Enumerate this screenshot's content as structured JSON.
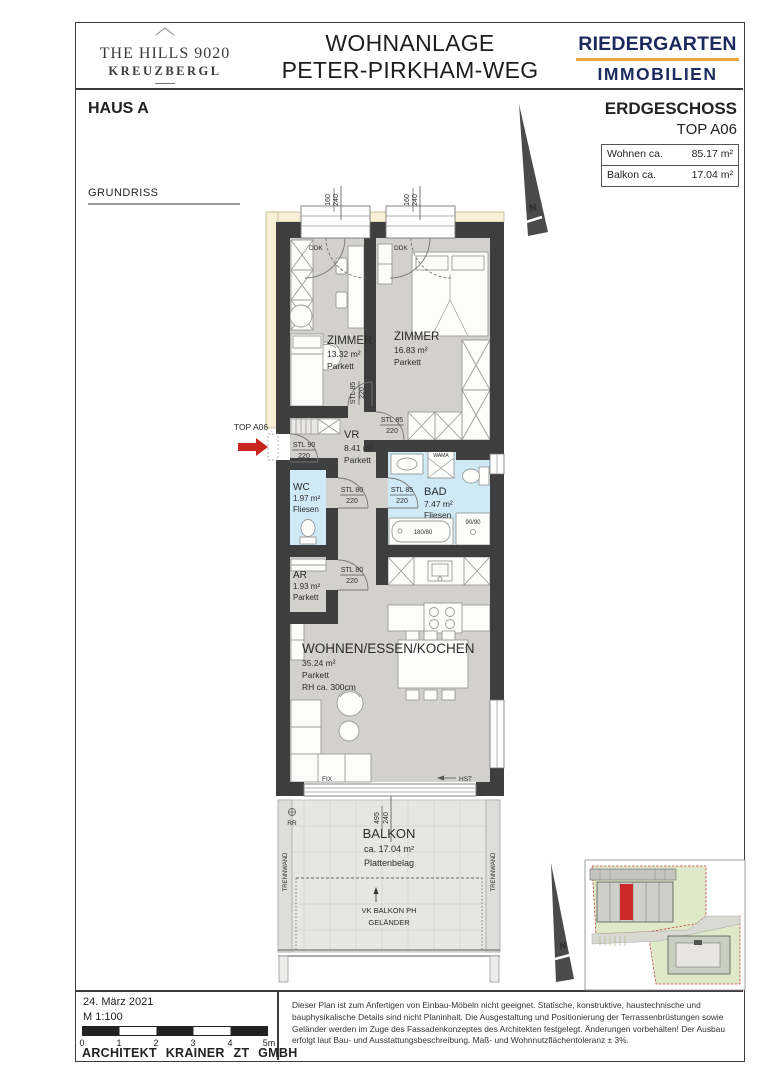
{
  "header": {
    "brand_left": {
      "line1": "THE HILLS 9020",
      "line2": "KREUZBERGL"
    },
    "project_title": {
      "line1": "WOHNANLAGE",
      "line2": "PETER-PIRKHAM-WEG"
    },
    "brand_right": {
      "line1": "RIEDERGARTEN",
      "line2": "IMMOBILIEN"
    }
  },
  "info": {
    "house": "HAUS A",
    "floor": "ERDGESCHOSS",
    "unit": "TOP A06",
    "area_table": {
      "rows": [
        {
          "label": "Wohnen ca.",
          "value": "85.17 m²"
        },
        {
          "label": "Balkon ca.",
          "value": "17.04 m²"
        }
      ]
    },
    "drawing_type": "GRUNDRISS"
  },
  "plan": {
    "north": "N",
    "entrance_label": "TOP A06",
    "rooms": {
      "zimmer1": {
        "name": "ZIMMER",
        "area": "13.32 m²",
        "floor": "Parkett"
      },
      "zimmer2": {
        "name": "ZIMMER",
        "area": "16.83 m²",
        "floor": "Parkett"
      },
      "vr": {
        "name": "VR",
        "area": "8.41 m²",
        "floor": "Parkett"
      },
      "wc": {
        "name": "WC",
        "area": "1.97 m²",
        "floor": "Fliesen"
      },
      "bad": {
        "name": "BAD",
        "area": "7.47 m²",
        "floor": "Fliesen"
      },
      "ar": {
        "name": "AR",
        "area": "1.93 m²",
        "floor": "Parkett"
      },
      "wohnen": {
        "name": "WOHNEN/ESSEN/KOCHEN",
        "area": "35.24 m²",
        "floor": "Parkett",
        "room_height": "RH ca. 300cm"
      },
      "balkon": {
        "name": "BALKON",
        "area": "ca. 17.04 m²",
        "floor": "Plattenbelag"
      }
    },
    "doors": {
      "entrance": {
        "type": "STL 90",
        "height": "220"
      },
      "zimmer1": {
        "type": "STL 85",
        "height": "220"
      },
      "zimmer2": {
        "type": "STL 85",
        "height": "220"
      },
      "wc": {
        "type": "STL 80",
        "height": "220"
      },
      "bad": {
        "type": "STL 85",
        "height": "220"
      },
      "ar": {
        "type": "STL 80",
        "height": "220"
      }
    },
    "dims": {
      "window": {
        "w": "160",
        "h": "240"
      },
      "balcony_door": {
        "w": "495",
        "h": "240"
      }
    },
    "annotations": {
      "ddk": "DDK",
      "fix": "FIX",
      "hst": "HST",
      "rr": "RR",
      "trennwand": "TRENNWAND",
      "vk_balkon": "VK BALKON PH",
      "gelaender": "GELÄNDER",
      "wama": "WAMA",
      "bathtub": "180/80",
      "shower": "90/90"
    }
  },
  "footer": {
    "date": "24. März 2021",
    "scale": "M 1:100",
    "scale_ticks": [
      "0",
      "1",
      "2",
      "3",
      "4",
      "5m"
    ],
    "architect": "ARCHITEKT KRAINER ZT GMBH",
    "disclaimer": "Dieser Plan ist zum Anfertigen von Einbau-Möbeln nicht geeignet. Statische, konstruktive, haustechnische und bauphysikalische Details sind nicht Planinhalt. Die Ausgestaltung und Positionierung der Terrassenbrüstungen sowie Geländer werden im Zuge des Fassadenkonzeptes des Architekten festgelegt. Änderungen vorbehalten! Der Ausbau erfolgt laut Bau- und Ausstattungsbeschreibung. Maß- und Wohnnutzflächentoleranz ± 3%."
  },
  "colors": {
    "wall": "#3e3e3e",
    "floor": "#d3d1ce",
    "tile_blue": "#cfe9f6",
    "balcony": "#e6e6e3",
    "insulation": "#f7f0d4",
    "accent_red": "#c8251f",
    "brand_navy": "#1c2b5e",
    "brand_orange": "#f2a33c",
    "site_green": "#dfe9c8"
  }
}
